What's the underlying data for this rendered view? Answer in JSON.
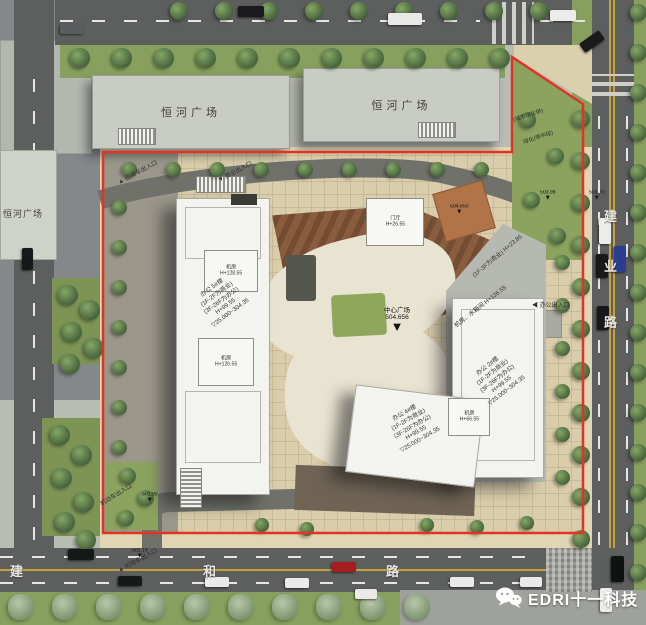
{
  "colors": {
    "boundary_red": "#e23422",
    "road_grey": "#5d5f5e",
    "site_beige": "#d9cdab",
    "deck_brown": "#8a5c3e",
    "lawn_green": "#8ba35f",
    "tower_white": "#f3f3ef"
  },
  "roads": {
    "bottom": {
      "chars": [
        {
          "ch": "建",
          "x": 10
        },
        {
          "ch": "和",
          "x": 203
        },
        {
          "ch": "路",
          "x": 386
        }
      ]
    },
    "right": {
      "chars": [
        {
          "ch": "建",
          "y": 206
        },
        {
          "ch": "业",
          "y": 256
        },
        {
          "ch": "路",
          "y": 312
        }
      ]
    }
  },
  "plaza_buildings": {
    "top_left": "恒河广场",
    "top_right": "恒河广场",
    "left": "恒河广场"
  },
  "towers": {
    "left": {
      "lines": [
        "办公 5#楼",
        "(1F-2F为商业)",
        "(3F-26F为办公)",
        "H+99.55",
        "▽25.000~304.35"
      ],
      "roof_top": [
        "机房",
        "H+128.55"
      ],
      "roof_bottom": [
        "机房",
        "H+126.55"
      ]
    },
    "right": {
      "lines": [
        "办公 2#楼",
        "(1F-2F为商业)",
        "(3F-26F为办公)",
        "H+99.55",
        "▽25.000~304.35"
      ],
      "roof": "机房、水箱间 H+126.55",
      "podium": "(1F-3F为商业) H+23.85"
    },
    "bottom": {
      "lines": [
        "办公 4#楼",
        "(1F-2F为商业)",
        "(3F-26F为办公)",
        "H+99.55",
        "▽25.000~304.35"
      ],
      "roof": [
        "机房",
        "H+66.55"
      ]
    },
    "lobby": [
      "门厅",
      "H+26.55"
    ]
  },
  "markers": [
    {
      "text": "503.98",
      "x": 540,
      "y": 190
    },
    {
      "text": "503.70",
      "x": 589,
      "y": 190
    },
    {
      "text": "504.650",
      "x": 450,
      "y": 204
    },
    {
      "text": "501.90",
      "x": 142,
      "y": 492
    },
    {
      "text": "501.19",
      "x": 132,
      "y": 548
    },
    {
      "text": "504.656",
      "x": 384,
      "y": 308,
      "big": true,
      "title": "中心广场"
    }
  ],
  "entrances": [
    {
      "text": "机动车出入口",
      "x": 116,
      "y": 178,
      "rot": -28,
      "arrow": "▲"
    },
    {
      "text": "商业出入口",
      "x": 216,
      "y": 176,
      "rot": -28,
      "arrow": "▼"
    },
    {
      "text": "办公出入口",
      "x": 532,
      "y": 300,
      "rot": 0,
      "arrow": "◀"
    },
    {
      "text": "机动车出入口",
      "x": 98,
      "y": 500,
      "rot": -32,
      "arrow": ""
    },
    {
      "text": "机动车出入口",
      "x": 116,
      "y": 566,
      "rot": -28,
      "arrow": "▲"
    }
  ],
  "green_labels": [
    {
      "text": "(城市绿化带)",
      "x": 512,
      "y": 116,
      "rot": -18
    },
    {
      "text": "绿化(带中段)",
      "x": 522,
      "y": 138,
      "rot": -18
    }
  ],
  "logo": {
    "text": "EDRI十一科技"
  }
}
